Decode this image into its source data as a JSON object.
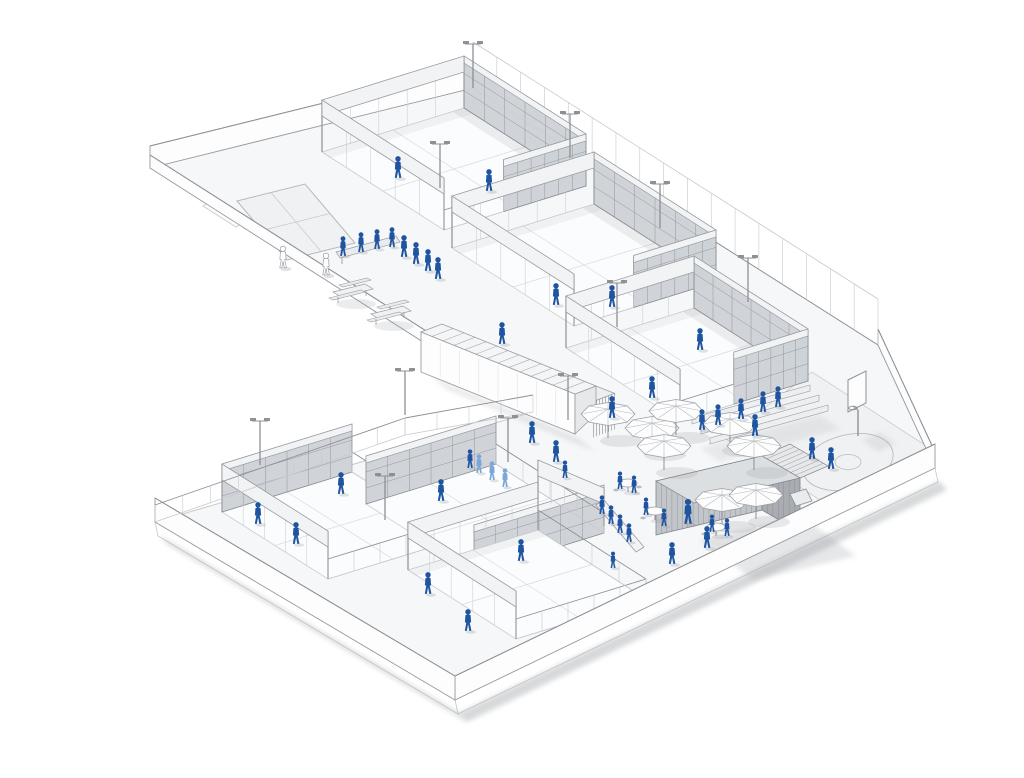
{
  "meta": {
    "alt": "Axonometric architectural rendering of a padel sports club: two terraces of glass-and-mesh padel courts, a central plaza with parasols, tables, a corrugated kiosk container, bleachers, a basketball half-court and many blue human figures",
    "canvas": {
      "width": 1024,
      "height": 778
    }
  },
  "palette": {
    "background": "#ffffff",
    "surface": "#f6f7f8",
    "court_floor": "#fbfcfd",
    "line": "#8d9196",
    "line_light": "#c6c9cd",
    "mesh_fill": "#ced2d6",
    "mesh_line": "#888c91",
    "beam_fill": "#f2f3f5",
    "beam_stroke": "#989da2",
    "wall_fill": "#fdfdfe",
    "shadow": "#a6aaaf",
    "shadow_soft": "#c7cacd",
    "figure": "#1f55a0",
    "figure_light": "#7da6d8",
    "kiosk_front": "#c2c6ca",
    "kiosk_side": "#a9adb2",
    "kiosk_line": "#80848a",
    "kiosk_top": "#dcdfe2",
    "basket_tint": "#eff1f2"
  },
  "summary": {
    "people": 54,
    "padel_courts": 6,
    "umbrellas": 8,
    "light_poles": 11,
    "basketball_hoops": 1,
    "picnic_tables": 2,
    "cafe_tables": 3,
    "bleacher_rows": 3,
    "container_buildings": 2
  },
  "scene": {
    "site_outline": [
      [
        150,
        168
      ],
      [
        473,
        88
      ],
      [
        878,
        345
      ],
      [
        935,
        468
      ],
      [
        455,
        700
      ],
      [
        155,
        522
      ],
      [
        533,
        412
      ]
    ],
    "slab_shadow_edges": [
      [
        [
          935,
          468
        ],
        [
          455,
          700
        ]
      ],
      [
        [
          455,
          700
        ],
        [
          155,
          522
        ]
      ]
    ],
    "walls_back": [
      {
        "a": [
          150,
          168
        ],
        "b": [
          473,
          88
        ],
        "h": 22,
        "type": "solid",
        "name": "north-boundary-wall"
      },
      {
        "a": [
          150,
          168
        ],
        "b": [
          533,
          412
        ],
        "h": 13,
        "type": "solid",
        "name": "upper-west-parapet"
      },
      {
        "a": [
          878,
          345
        ],
        "b": [
          935,
          468
        ],
        "h": 16,
        "type": "solid",
        "name": "east-boundary-parapet"
      }
    ],
    "fence_ne": {
      "a": [
        473,
        88
      ],
      "b": [
        878,
        345
      ],
      "h": 46
    },
    "walls_front": [
      {
        "a": [
          935,
          468
        ],
        "b": [
          455,
          700
        ],
        "h": 24,
        "type": "solid",
        "name": "southeast-parapet"
      },
      {
        "a": [
          455,
          700
        ],
        "b": [
          155,
          522
        ],
        "h": 24,
        "type": "solid",
        "name": "southwest-parapet"
      },
      {
        "a": [
          155,
          522
        ],
        "b": [
          405,
          435
        ],
        "h": 17,
        "type": "glass",
        "name": "lower-north-fence-west"
      },
      {
        "a": [
          405,
          435
        ],
        "b": [
          533,
          412
        ],
        "h": 17,
        "type": "glass",
        "name": "lower-north-fence-east"
      }
    ],
    "courts": [
      {
        "id": "upper-1",
        "w": [
          322,
          152
        ],
        "n": [
          464,
          108
        ],
        "e": [
          586,
          186
        ],
        "s": [
          444,
          230
        ],
        "mesh": [
          "ne",
          "se"
        ],
        "beams": [
          "nw",
          "sw"
        ],
        "glass": [],
        "h": 52
      },
      {
        "id": "upper-2",
        "w": [
          452,
          248
        ],
        "n": [
          594,
          204
        ],
        "e": [
          716,
          282
        ],
        "s": [
          574,
          326
        ],
        "mesh": [
          "ne",
          "se"
        ],
        "beams": [
          "nw",
          "sw"
        ],
        "glass": [],
        "h": 52
      },
      {
        "id": "upper-3",
        "w": [
          566,
          348
        ],
        "n": [
          694,
          308
        ],
        "e": [
          808,
          381
        ],
        "s": [
          680,
          421
        ],
        "mesh": [
          "ne",
          "se"
        ],
        "beams": [
          "nw",
          "sw"
        ],
        "glass": [],
        "h": 52
      },
      {
        "id": "lower-1",
        "w": [
          222,
          512
        ],
        "n": [
          352,
          472
        ],
        "e": [
          458,
          539
        ],
        "s": [
          328,
          579
        ],
        "mesh": [
          "nw"
        ],
        "beams": [
          "sw"
        ],
        "glass": [
          "ne",
          "se"
        ],
        "h": 48
      },
      {
        "id": "lower-2",
        "w": [
          366,
          504
        ],
        "n": [
          496,
          464
        ],
        "e": [
          604,
          533
        ],
        "s": [
          474,
          573
        ],
        "mesh": [
          "nw",
          "se"
        ],
        "beams": [],
        "glass": [
          "ne"
        ],
        "h": 48
      },
      {
        "id": "lower-3",
        "w": [
          408,
          570
        ],
        "n": [
          538,
          530
        ],
        "e": [
          646,
          599
        ],
        "s": [
          516,
          639
        ],
        "mesh": [],
        "beams": [
          "sw",
          "nw"
        ],
        "glass": [
          "se",
          "ne"
        ],
        "h": 48
      }
    ],
    "marked_court": {
      "quad": [
        [
          237,
          201
        ],
        [
          305,
          184
        ],
        [
          355,
          243
        ],
        [
          287,
          260
        ]
      ]
    },
    "ramp": {
      "quad": [
        [
          203,
          206
        ],
        [
          210,
          202
        ],
        [
          243,
          223
        ],
        [
          236,
          227
        ]
      ],
      "arrow_from": [
        238,
        223
      ],
      "arrow_to": [
        250,
        229
      ]
    },
    "bench": {
      "quad": [
        [
          336,
          252
        ],
        [
          396,
          236
        ],
        [
          400,
          242
        ],
        [
          340,
          258
        ]
      ]
    },
    "picnic_tables": [
      [
        352,
        302
      ],
      [
        390,
        324
      ]
    ],
    "container": {
      "a": [
        421,
        332
      ],
      "b": [
        575,
        394
      ],
      "h": 40,
      "d": [
        21,
        -8
      ],
      "ext": 20,
      "fins": 7,
      "slats": 14
    },
    "kiosk": {
      "a": [
        656,
        481
      ],
      "b": [
        762,
        456
      ],
      "h": 54,
      "d": [
        38,
        22
      ],
      "canopy": [
        [
          762,
          456
        ],
        [
          800,
          478
        ],
        [
          828,
          466
        ],
        [
          790,
          444
        ]
      ]
    },
    "bleachers": {
      "rows": 3,
      "a": [
        692,
        424
      ],
      "b": [
        810,
        391
      ],
      "step": [
        9,
        10
      ],
      "h": 6
    },
    "counter": {
      "quad": [
        [
          596,
          505
        ],
        [
          604,
          500
        ],
        [
          644,
          547
        ],
        [
          636,
          552
        ]
      ]
    },
    "portal": {
      "a": [
        538,
        498
      ],
      "b": [
        604,
        526
      ],
      "h1": 22,
      "h2": 38
    },
    "basketball": {
      "court": [
        [
          812,
          372
        ],
        [
          928,
          447
        ],
        [
          840,
          513
        ],
        [
          724,
          438
        ]
      ],
      "arc": {
        "c": [
          848,
          462
        ],
        "rx": 46,
        "ry": 27,
        "rot": -14
      },
      "circle": {
        "c": [
          848,
          462
        ],
        "rx": 13,
        "ry": 7.5
      },
      "board": [
        [
          848,
          380
        ],
        [
          866,
          371
        ],
        [
          866,
          403
        ],
        [
          848,
          412
        ]
      ],
      "pole": [
        [
          858,
          436
        ],
        [
          858,
          410
        ]
      ],
      "ring": {
        "c": [
          853,
          408
        ],
        "rx": 4.2,
        "ry": 1.8
      }
    },
    "cart": {
      "quad": [
        [
          790,
          494
        ],
        [
          806,
          489
        ],
        [
          812,
          501
        ],
        [
          796,
          506
        ]
      ]
    },
    "umbrellas": [
      [
        608,
        438
      ],
      [
        652,
        452
      ],
      [
        676,
        435
      ],
      [
        730,
        448
      ],
      [
        754,
        470
      ],
      [
        664,
        470
      ],
      [
        722,
        524
      ],
      [
        756,
        519
      ]
    ],
    "tables": [
      [
        628,
        492
      ],
      [
        716,
        536
      ],
      [
        655,
        520
      ]
    ],
    "poles": [
      [
        473,
        88
      ],
      [
        570,
        158
      ],
      [
        660,
        228
      ],
      [
        748,
        302
      ],
      [
        440,
        188
      ],
      [
        617,
        327
      ],
      [
        568,
        420
      ],
      [
        260,
        465
      ],
      [
        385,
        520
      ],
      [
        508,
        462
      ],
      [
        405,
        415
      ]
    ],
    "shadows": [
      {
        "pts": [
          [
            700,
            540
          ],
          [
            802,
            516
          ],
          [
            856,
            556
          ],
          [
            754,
            580
          ]
        ],
        "o": 0.28
      },
      {
        "pts": [
          [
            430,
            376
          ],
          [
            578,
            438
          ],
          [
            596,
            452
          ],
          [
            448,
            390
          ]
        ],
        "o": 0.25
      },
      {
        "pts": [
          [
            700,
            448
          ],
          [
            820,
            415
          ],
          [
            840,
            429
          ],
          [
            720,
            462
          ]
        ],
        "o": 0.18
      },
      {
        "pts": [
          [
            862,
            440
          ],
          [
            880,
            432
          ],
          [
            896,
            444
          ],
          [
            878,
            452
          ]
        ],
        "o": 0.2
      }
    ],
    "figures": [
      [
        398,
        178
      ],
      [
        489,
        191
      ],
      [
        343,
        256,
        "d",
        0.9
      ],
      [
        361,
        252,
        "d",
        0.9
      ],
      [
        377,
        249,
        "d",
        0.9
      ],
      [
        392,
        247,
        "d",
        0.9
      ],
      [
        404,
        257
      ],
      [
        416,
        264
      ],
      [
        428,
        271
      ],
      [
        438,
        279
      ],
      [
        283,
        268,
        "g"
      ],
      [
        326,
        275,
        "g"
      ],
      [
        556,
        305
      ],
      [
        612,
        307
      ],
      [
        700,
        350
      ],
      [
        652,
        398
      ],
      [
        612,
        418
      ],
      [
        502,
        344
      ],
      [
        556,
        462
      ],
      [
        532,
        443
      ],
      [
        565,
        478,
        "d",
        0.8
      ],
      [
        702,
        430,
        "d",
        0.95
      ],
      [
        718,
        425,
        "d",
        0.95
      ],
      [
        741,
        419,
        "d",
        0.95
      ],
      [
        763,
        412,
        "d",
        0.95
      ],
      [
        778,
        407,
        "d",
        0.95
      ],
      [
        755,
        436
      ],
      [
        688,
        524,
        "d",
        1.15
      ],
      [
        707,
        548
      ],
      [
        672,
        564
      ],
      [
        620,
        489,
        "d",
        0.8
      ],
      [
        634,
        493,
        "d",
        0.8
      ],
      [
        712,
        532,
        "d",
        0.8
      ],
      [
        727,
        536,
        "d",
        0.8
      ],
      [
        646,
        515,
        "d",
        0.8
      ],
      [
        664,
        526,
        "d",
        0.8
      ],
      [
        602,
        514,
        "d",
        0.85
      ],
      [
        611,
        524,
        "d",
        0.85
      ],
      [
        620,
        533,
        "d",
        0.85
      ],
      [
        629,
        542,
        "d",
        0.85
      ],
      [
        613,
        568,
        "d",
        0.75
      ],
      [
        812,
        459
      ],
      [
        831,
        469
      ],
      [
        296,
        544
      ],
      [
        341,
        494
      ],
      [
        258,
        524
      ],
      [
        441,
        501
      ],
      [
        521,
        561
      ],
      [
        428,
        594
      ],
      [
        468,
        631
      ],
      [
        479,
        473,
        "l",
        0.85
      ],
      [
        492,
        480,
        "l",
        0.85
      ],
      [
        505,
        487,
        "l",
        0.85
      ],
      [
        470,
        468,
        "d",
        0.85
      ]
    ]
  }
}
